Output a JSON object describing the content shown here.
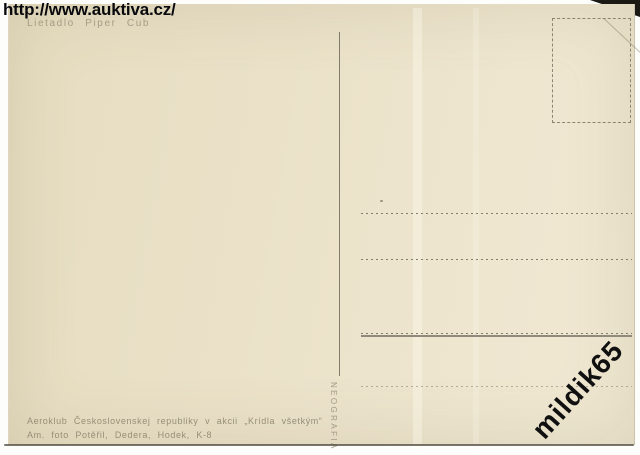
{
  "watermarks": {
    "site_url": "http://www.auktiva.cz/",
    "seller": "mildik65"
  },
  "postcard": {
    "caption": "Lietadlo Piper Cub",
    "printer": "NEOGRAFIA",
    "imprint_line1": "Aeroklub Československej republiky v akcii „Krídla všetkým“",
    "imprint_line2": "Am. foto Potěřil, Dedera, Hodek, K-8",
    "colors": {
      "card_background": "#eae1c8",
      "print_ink": "#9d947e",
      "ruled_lines": "#857d6b",
      "divider_line": "#6f6a5c",
      "watermark_ink": "#0a0a0c",
      "scanner_corner": "#1b1914"
    }
  }
}
